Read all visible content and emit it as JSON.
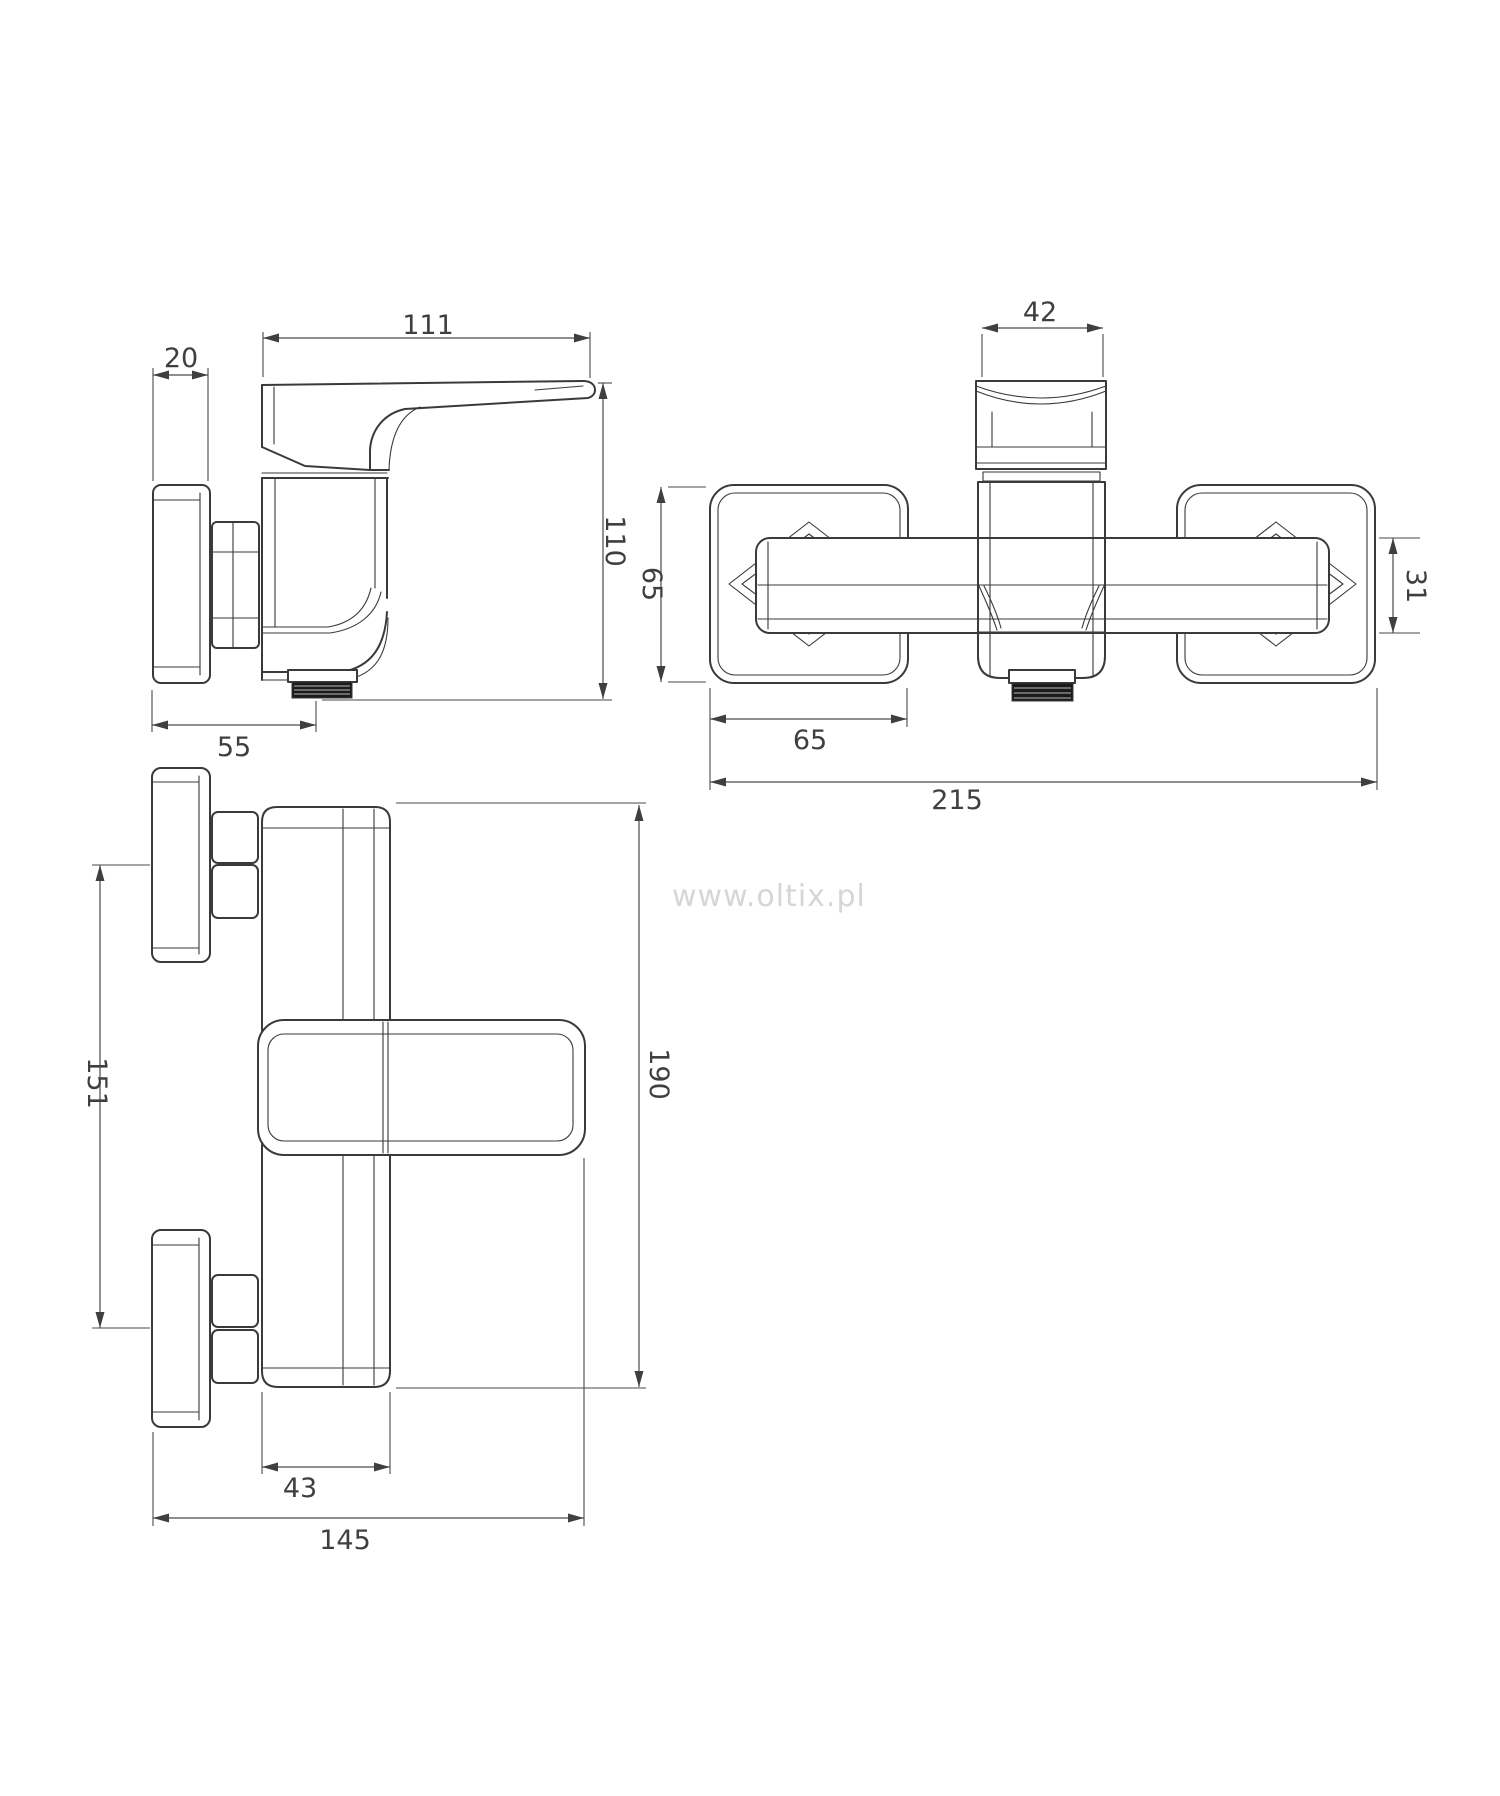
{
  "watermark": "www.oltix.pl",
  "dimensions": {
    "side": {
      "lever_length": "111",
      "plate_depth": "20",
      "height": "110",
      "wall_to_outlet": "55"
    },
    "front": {
      "handle_width": "42",
      "escutcheon_height": "65",
      "escutcheon_width": "65",
      "body_tube_height": "31",
      "total_width": "215"
    },
    "top": {
      "mount_spacing": "151",
      "total_depth": "190",
      "body_width": "43",
      "wall_to_handle_tip": "145"
    }
  },
  "colors": {
    "line": "#3a3a3a",
    "dim": "#4a4a4a",
    "text": "#3f3f3f",
    "watermark": "#d6d6d6",
    "thread": "#1b1b1b",
    "bg": "#ffffff"
  }
}
